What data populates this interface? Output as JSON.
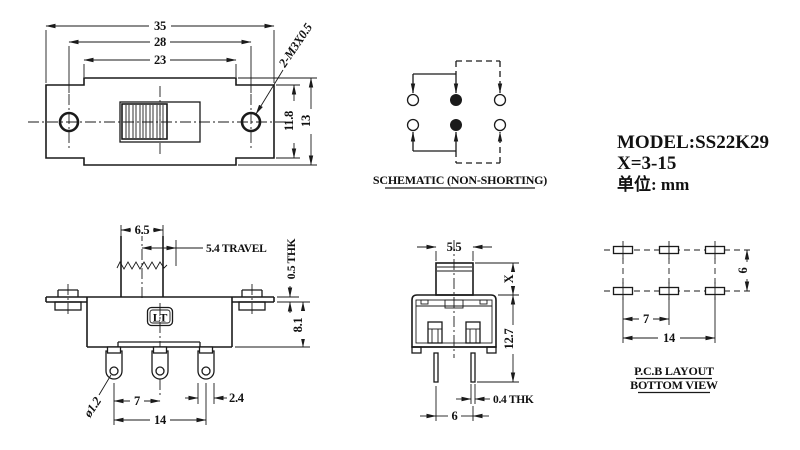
{
  "ink": "#1a1a1a",
  "top_view": {
    "width": "35",
    "hole_span": "28",
    "slot_span": "23",
    "height_inner": "11.8",
    "height": "13",
    "thread": "2-M3X0.5"
  },
  "schematic": {
    "title": "SCHEMATIC (NON-SHORTING)"
  },
  "info": {
    "model": "MODEL:SS22K29",
    "x_range": "X=3-15",
    "unit": "单位: mm"
  },
  "front_view": {
    "knob_width": "6.5",
    "travel": "5.4 TRAVEL",
    "flange_thk": "0.5 THK",
    "body_height": "8.1",
    "logo": "LT",
    "pin_hole": "ø1.2",
    "pin_pitch": "7",
    "pin_span": "14",
    "pin_width": "2.4"
  },
  "side_view": {
    "knob_width": "5.5",
    "knob_height": "X",
    "body_height": "12.7",
    "pin_thk": "0.4 THK",
    "pin_pitch": "6"
  },
  "pcb": {
    "row_pitch": "6",
    "col_pitch": "7",
    "col_span": "14",
    "title_1": "P.C.B LAYOUT",
    "title_2": "BOTTOM VIEW"
  }
}
